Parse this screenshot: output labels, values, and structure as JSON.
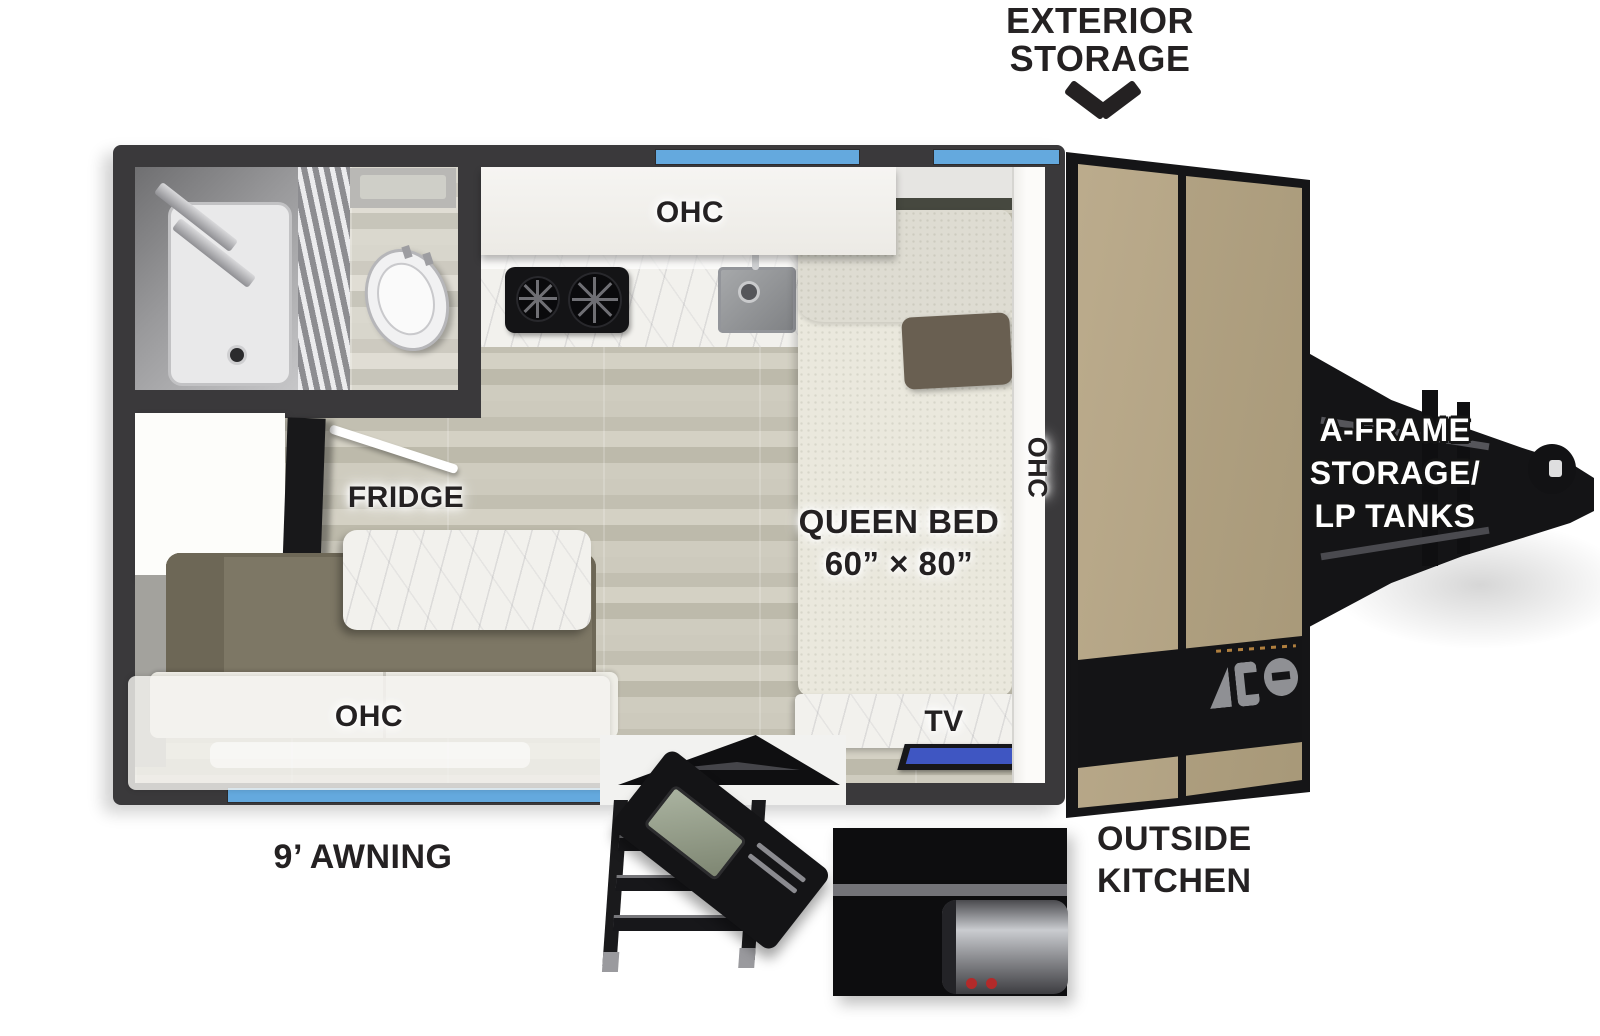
{
  "callouts": {
    "exterior_storage": [
      "EXTERIOR",
      "STORAGE"
    ],
    "awning": "9’ AWNING",
    "outside_kitchen": [
      "OUTSIDE",
      "KITCHEN"
    ],
    "a_frame": [
      "A-FRAME",
      "STORAGE/",
      "LP TANKS"
    ]
  },
  "interior_labels": {
    "kitchen_ohc": "OHC",
    "bedside_ohc": "OHC",
    "dinette_ohc": "OHC",
    "fridge": "FRIDGE",
    "queen_bed": [
      "QUEEN BED",
      "60” × 80”"
    ],
    "tv": "TV"
  },
  "icons": {
    "exterior_storage_arrow": "chevron-down"
  },
  "colors": {
    "wall": "#3a393b",
    "window_blue": "#64a9de",
    "front_panel_tan": "#b5a586",
    "frame_black": "#151517",
    "floor_wood": "#c9c6b9",
    "dinette_olive": "#7d7765",
    "marble": "#f2f1ed",
    "tv_screen": "#3f56c2",
    "label_text": "#242122"
  }
}
